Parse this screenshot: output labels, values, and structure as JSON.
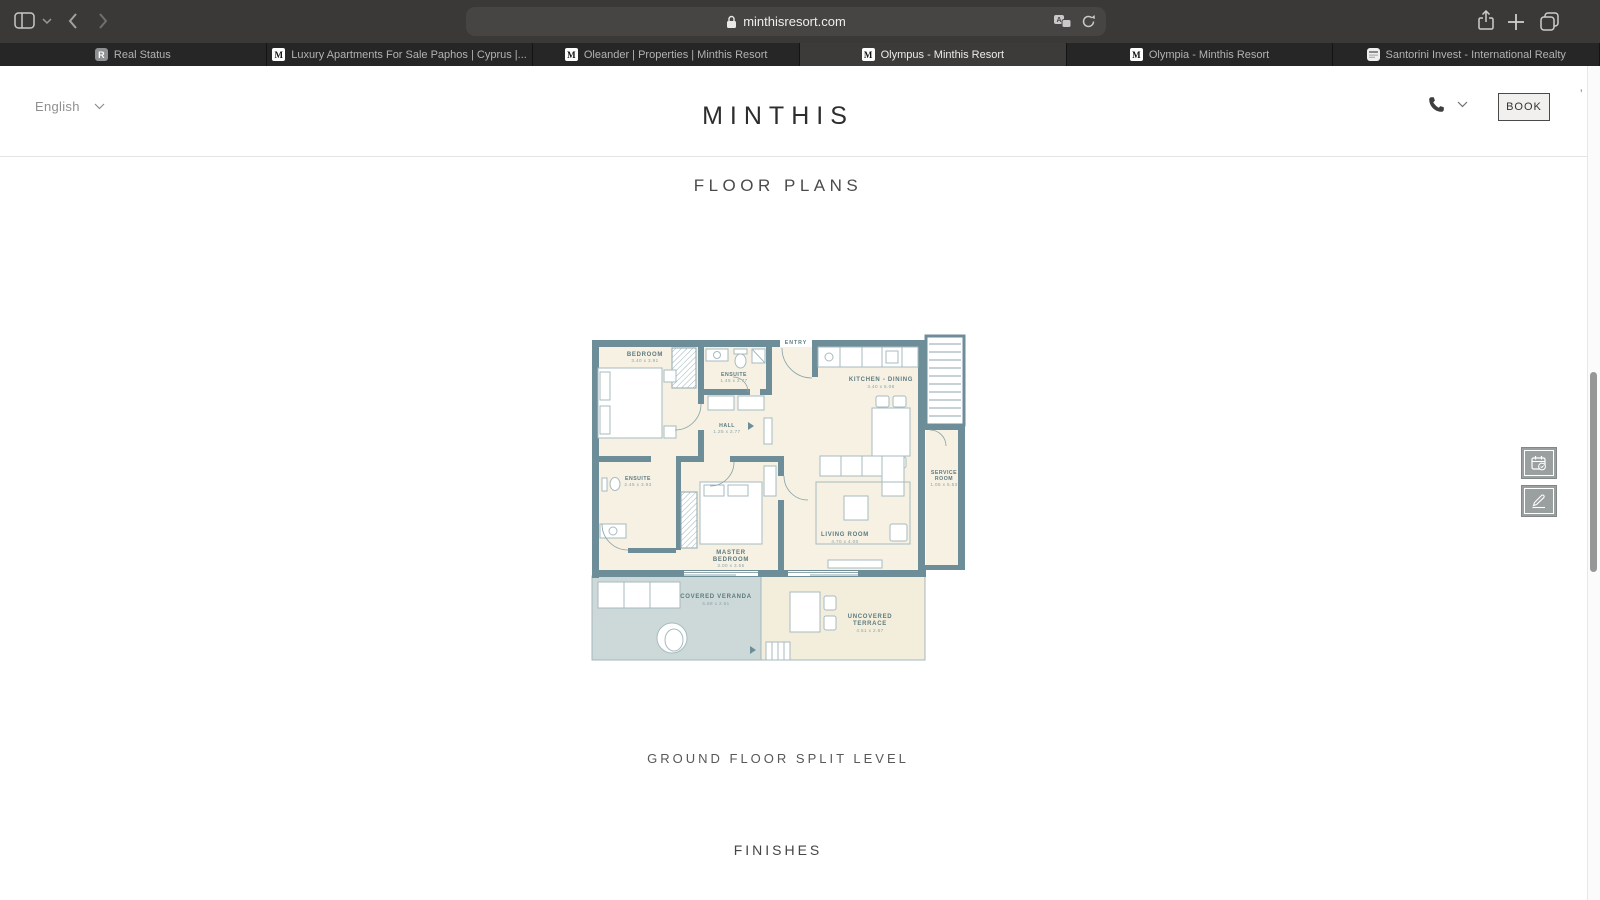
{
  "browser": {
    "chrome": {
      "url": "minthisresort.com"
    },
    "tabs": [
      {
        "title": "Real Status",
        "favicon_letter": "R",
        "active": false
      },
      {
        "title": "Luxury Apartments For Sale Paphos | Cyprus |...",
        "favicon_letter": "M",
        "active": false
      },
      {
        "title": "Oleander | Properties | Minthis Resort",
        "favicon_letter": "M",
        "active": false
      },
      {
        "title": "Olympus - Minthis Resort",
        "favicon_letter": "M",
        "active": true
      },
      {
        "title": "Olympia - Minthis Resort",
        "favicon_letter": "M",
        "active": false
      },
      {
        "title": "Santorini Invest - International Realty",
        "favicon_letter": "",
        "active": false
      }
    ]
  },
  "site": {
    "language_selector": "English",
    "logo": "MINTHIS",
    "book_button": "BOOK",
    "stray_glyph": "’"
  },
  "page": {
    "section_title": "FLOOR PLANS",
    "plan_caption": "GROUND FLOOR SPLIT LEVEL",
    "next_section_title": "FINISHES"
  },
  "floor_plan": {
    "colors": {
      "wall": "#6d8e99",
      "floor": "#f6f1e2",
      "veranda": "#cdd9d8",
      "terrace": "#f3eedc",
      "label": "#5d7a80",
      "dims": "#8ba3a9",
      "furniture": "#a7bbc0"
    },
    "rooms": {
      "bedroom": {
        "name": "BEDROOM",
        "dims": "3.40 x 3.91"
      },
      "ensuite1": {
        "name": "ENSUITE",
        "dims": "1.45 x 2.77"
      },
      "entry": {
        "name": "ENTRY"
      },
      "kitchen": {
        "name": "KITCHEN - DINING",
        "dims": "3.40 x 5.08"
      },
      "hall": {
        "name": "HALL",
        "dims": "1.25 x 2.77"
      },
      "service": {
        "name_line1": "SERVICE",
        "name_line2": "ROOM",
        "dims": "1.05 x 5.53"
      },
      "ensuite2": {
        "name": "ENSUITE",
        "dims": "2.45 x 3.93"
      },
      "master": {
        "name_line1": "MASTER",
        "name_line2": "BEDROOM",
        "dims": "3.00 x 3.55"
      },
      "living": {
        "name": "LIVING ROOM",
        "dims": "4.70 x 4.00"
      },
      "veranda": {
        "name": "COVERED VERANDA",
        "dims": "5.88 x 2.61"
      },
      "terrace": {
        "name_line1": "UNCOVERED",
        "name_line2": "TERRACE",
        "dims": "4.51 x 2.87"
      }
    }
  }
}
